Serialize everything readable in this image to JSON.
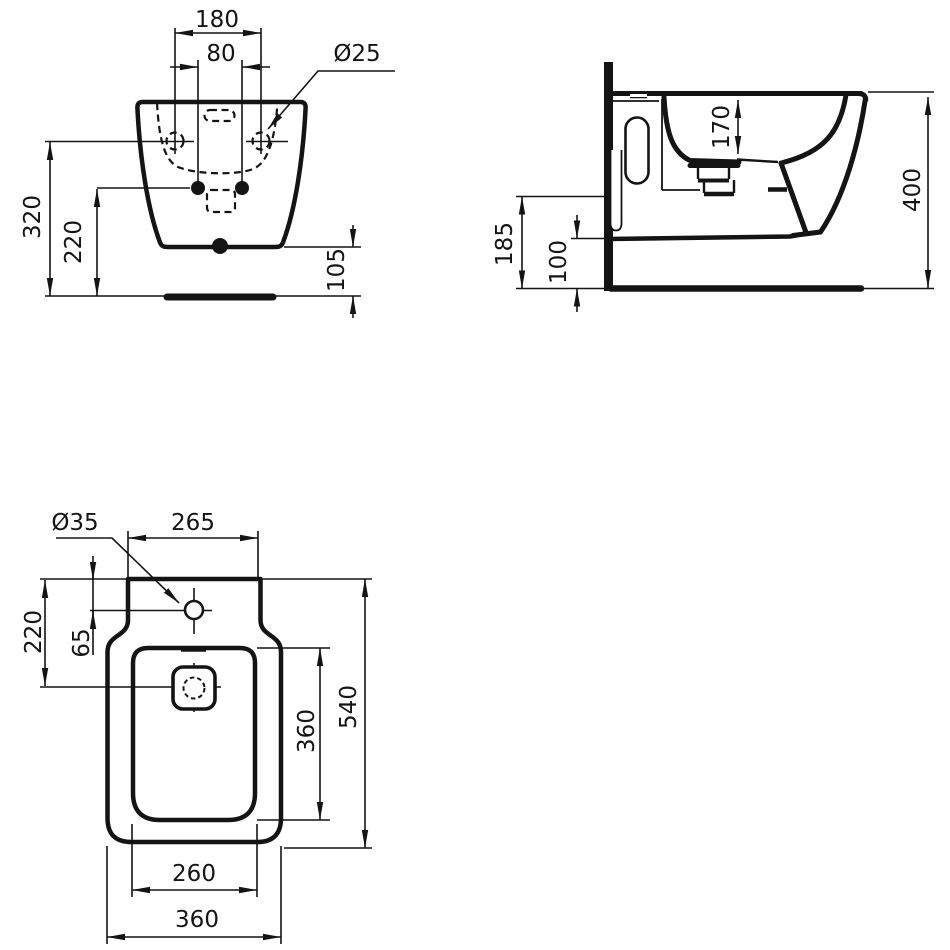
{
  "drawing": {
    "product": "wall-hung bidet installation drawing",
    "units": "mm",
    "line_color": "#141414",
    "background": "#ffffff"
  },
  "front_view": {
    "fixing_distance": "180",
    "inlet_distance": "80",
    "fixing_hole_diameter": "Ø25",
    "height_to_fixing": "320",
    "height_to_inlet": "220",
    "underside_height": "105"
  },
  "side_view": {
    "basin_depth": "170",
    "overall_height": "400",
    "front_clearance": "185",
    "underside_gap": "100"
  },
  "plan_view": {
    "tap_hole_diameter": "Ø35",
    "back_width": "265",
    "drain_distance": "220",
    "tap_hole_offset": "65",
    "bowl_length": "360",
    "overall_length": "540",
    "bowl_width": "260",
    "overall_width": "360"
  }
}
